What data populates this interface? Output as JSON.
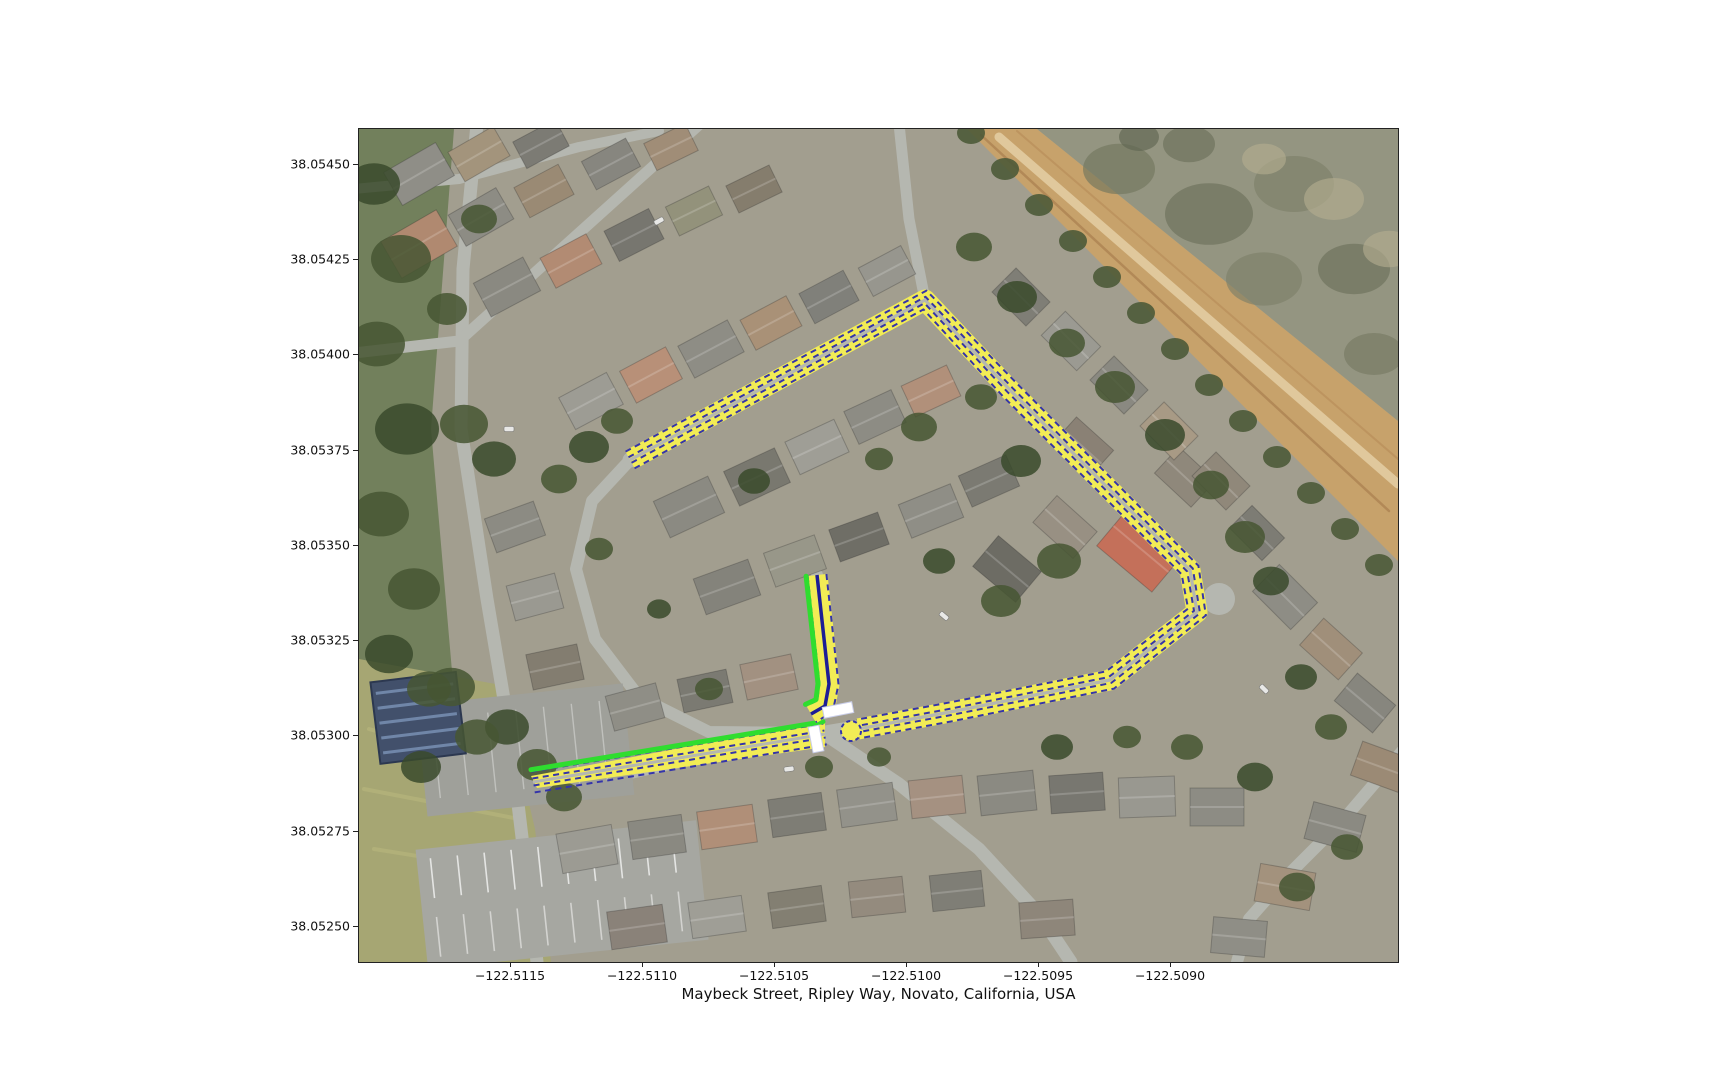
{
  "figure": {
    "xlabel": "Maybeck Street, Ripley Way, Novato, California, USA",
    "xtick_labels": [
      "−122.5115",
      "−122.5110",
      "−122.5105",
      "−122.5100",
      "−122.5095",
      "−122.5090"
    ],
    "ytick_labels": [
      "38.05450",
      "38.05425",
      "38.05400",
      "38.05375",
      "38.05350",
      "38.05325",
      "38.05300",
      "38.05275",
      "38.05250"
    ]
  },
  "map": {
    "basemap": "aerial",
    "colors": {
      "route_fill": "#f2ec55",
      "route_casing": "#3434aa",
      "route_centerline": "#1d1d96",
      "green_highlight": "#2fdd2f",
      "intersection_marker": "#ffffff"
    }
  }
}
